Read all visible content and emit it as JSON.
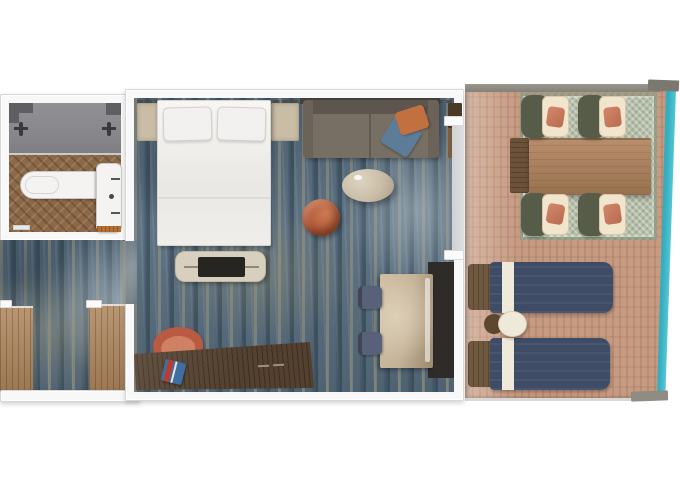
{
  "image_type": "floor-plan-top-view",
  "subject": "cruise-ship-stateroom-with-private-balcony",
  "visible_text": "none",
  "rooms": {
    "bathroom": {
      "label": "bathroom",
      "items": [
        "walk-in-shower",
        "shower-head-left",
        "shower-head-right",
        "toilet",
        "vanity-sink",
        "herringbone-wood-floor",
        "door-threshold",
        "bath-mat"
      ]
    },
    "entry": {
      "label": "entry-hall",
      "items": [
        "wardrobe-left",
        "wardrobe-right",
        "corridor-carpet"
      ]
    },
    "bedroom": {
      "label": "bedroom-living-area",
      "items": [
        "headboard-trim",
        "double-bed",
        "pillow-left",
        "pillow-right",
        "nightstand-left",
        "nightstand-right",
        "sofa",
        "throw-pillow-orange",
        "throw-pillow-blue",
        "wall-cabinet",
        "oval-coffee-table",
        "round-accent-chair",
        "tv-console",
        "tv",
        "desk",
        "desk-chair",
        "book",
        "side-dining-table",
        "side-chair-upper",
        "side-chair-lower",
        "dark-floor-mat",
        "balcony-sliding-door"
      ]
    },
    "balcony": {
      "label": "private-balcony",
      "items": [
        "wood-deck",
        "outdoor-rug",
        "outdoor-dining-table",
        "outdoor-bench",
        "outdoor-chair-top-left",
        "outdoor-chair-top-right",
        "outdoor-chair-bottom-left",
        "outdoor-chair-bottom-right",
        "sun-lounger-top",
        "sun-lounger-bottom",
        "round-side-table",
        "railing-cap-top",
        "railing-cap-bottom",
        "sea-edge"
      ]
    }
  },
  "palette": {
    "wall": "#f8f8f8",
    "wall_edge": "#d7d7d7",
    "carpet_base": "#5b6f80",
    "bathroom_tile": "#87878c",
    "bathroom_tile_dark": "#5e5e63",
    "bathroom_wood": "#8a6848",
    "closet_wood": "#ad855c",
    "deck_wood": "#c79b82",
    "balcony_rug": "#b6bfaa",
    "outdoor_table": "#ab8163",
    "chair_shell": "#575c49",
    "chair_cushion": "#f2e5cd",
    "coral_pillow": "#d2876b",
    "lounger_navy": "#3e4c66",
    "lounger_stripe": "#efe9da",
    "headrest_brown": "#6e583f",
    "sea_teal": "#35aec0",
    "bed_white": "#f4f3f1",
    "sofa_gray": "#776e64",
    "sofa_back": "#5d564e",
    "pillow_orange": "#c2703f",
    "pillow_blue": "#5d7c98",
    "accent_chair": "#b05a38",
    "coffee_table": "#c9bda7",
    "desk_wood": "#53402f",
    "desk_chair": "#b85b42",
    "tv_console": "#d8cfbe",
    "tv_screen": "#26251f",
    "table_beige": "#c3b096",
    "dark_mat": "#2e2b28",
    "side_chair_blue": "#596079",
    "nightstand": "#c9bda6",
    "threshold_orange": "#b5702f",
    "trim_dash": "#4d4943"
  }
}
